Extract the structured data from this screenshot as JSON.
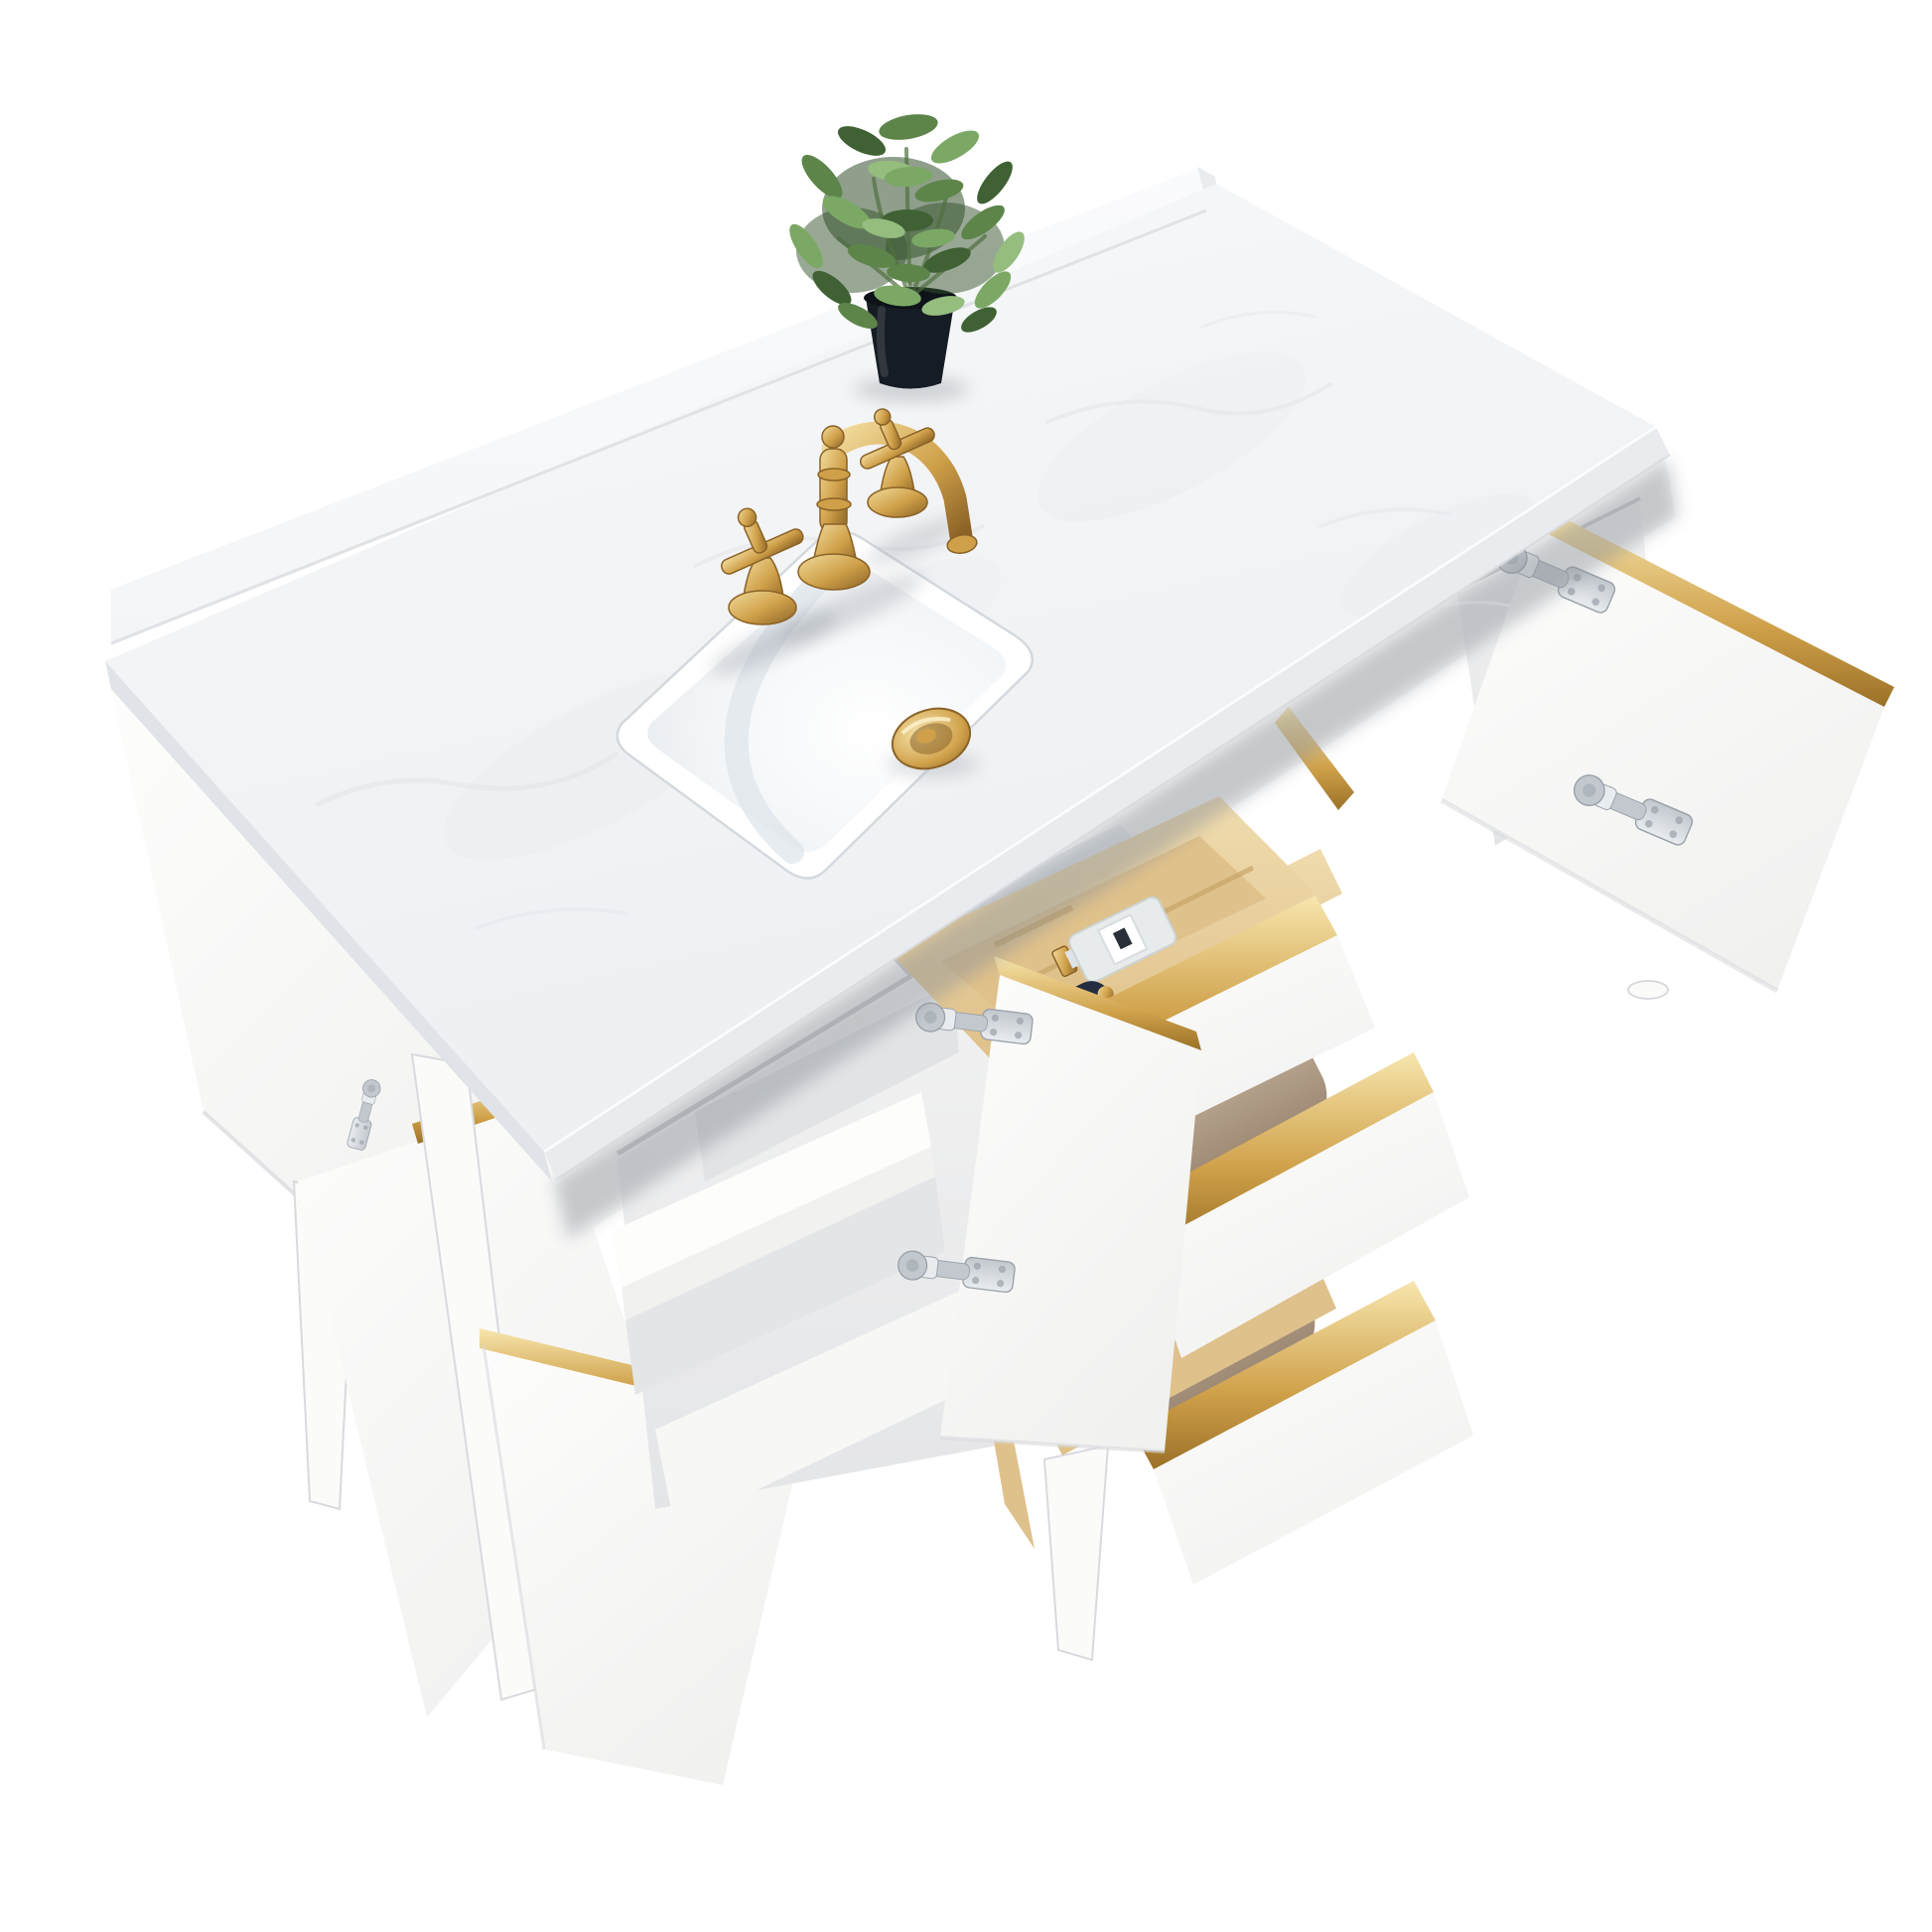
{
  "meta": {
    "description": "Studio product photo of a white bathroom vanity viewed from above at an angle: white marble countertop with backsplash, brushed gold three-hole faucet with two cross handles, white rectangular undermount sink with gold pop-up drain, small green plant in a black pot, and a white cabinet with gold-trimmed open doors and three pulled-out drawers containing folded tan towels and a wooden organizer with a perfume bottle and a dark cosmetic bottle, on tapered white legs against a pure white background",
    "background_color": "#ffffff"
  },
  "palette": {
    "bg": "#ffffff",
    "marbleA": "#f7f8f9",
    "marbleB": "#edeff2",
    "marbleVein": "#dfe3e8",
    "marbleEdge": "#e9ebee",
    "marbleEdgeDark": "#e0e3e7",
    "splash": "#f8f9fa",
    "cabWhite": "#fbfbfa",
    "cabBright": "#fdfdfc",
    "cabShade": "#f1f1f0",
    "cabLine": "#d8dade",
    "recessA": "#f3f3f3",
    "recessB": "#e4e5e7",
    "recessDark": "#dfe1e3",
    "railWhite": "#f7f7f6",
    "goldLight": "#f2dc9e",
    "goldMid": "#cfa049",
    "goldDark": "#8a6226",
    "nickelA": "#e9ecef",
    "nickelB": "#c3c8ce",
    "nickelDark": "#9aa1a9",
    "woodA": "#f0dcae",
    "woodB": "#dfc18b",
    "woodC": "#c8a56a",
    "towel": "#b5a28c",
    "towelDark": "#9a8570",
    "towelLight": "#c8b7a2",
    "ceramic": "#ffffff",
    "ceramicShade": "#e2e8ed",
    "potBlack": "#161c24",
    "potRim": "#0d1319",
    "green1": "#3f6134",
    "green2": "#5d8549",
    "green3": "#7ba864",
    "green4": "#94bd7e",
    "greenDark": "#33512b",
    "greenStem": "#516f40",
    "shadow": "#8a9098"
  },
  "objects": [
    {
      "name": "countertop",
      "label": "white marble countertop with backsplash"
    },
    {
      "name": "sink-basin",
      "label": "white rectangular undermount sink"
    },
    {
      "name": "sink-drain",
      "label": "gold pop-up drain cap"
    },
    {
      "name": "faucet",
      "label": "brushed gold widespread faucet with two cross handles"
    },
    {
      "name": "potted-plant",
      "label": "green faux plant in black tapered pot"
    },
    {
      "name": "left-doors",
      "label": "two open left cabinet doors with gold edge trim"
    },
    {
      "name": "center-door",
      "label": "open center door with nickel hinges and gold trim"
    },
    {
      "name": "right-door",
      "label": "open right door with nickel hinges and gold trim"
    },
    {
      "name": "compartment-shelf",
      "label": "white interior shelf"
    },
    {
      "name": "drawer-top",
      "label": "tilted top drawer with wooden organizer, perfume bottle and dark cosmetic bottle"
    },
    {
      "name": "drawer-middle",
      "label": "open middle drawer with folded tan towel"
    },
    {
      "name": "drawer-bottom",
      "label": "open bottom drawer with folded tan towel"
    },
    {
      "name": "legs",
      "label": "tapered white legs"
    }
  ]
}
